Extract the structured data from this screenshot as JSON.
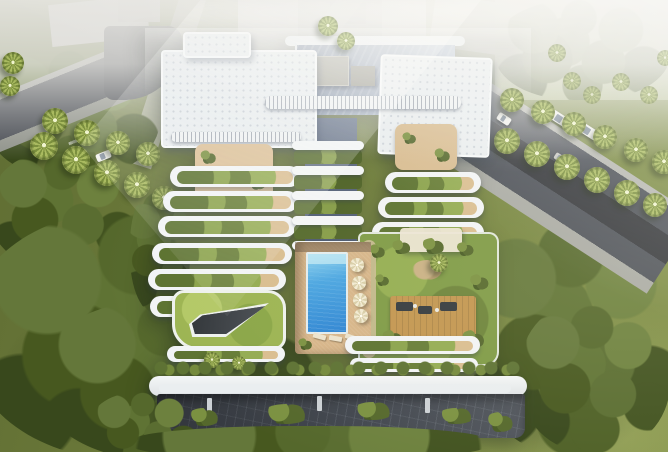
{
  "scene": {
    "type": "aerial-architectural-rendering",
    "description": "Aerial render of a luxury terraced residential building with cascading planted balconies, a rooftop courtyard with rectangular swimming pool and cream umbrellas, a lawn roof with an angular water feature, a garden lounge terrace with wooden deck, covered parking at grade, palm-lined streets with cars, dense surrounding trees and a hazy city background",
    "palette": {
      "haze_white": "#e8e7e3",
      "grass_green": "#6e7c3b",
      "tree_green": "#55682c",
      "asphalt_gray": "#42464e",
      "building_white": "#f2f4f6",
      "roof_deck_blue_gray": "#93a0b2",
      "pool_blue": "#2e86d4",
      "deck_beige": "#d6b488",
      "umbrella_cream": "#f1ead2",
      "roof_lawn_green": "#9cb452",
      "wood_deck_tan": "#c2954f",
      "water_feature_dark": "#3b3f43"
    },
    "counts": {
      "pool_umbrellas": 4,
      "cars": 5,
      "palm_trees": 34,
      "terrace_rows_left": 6,
      "terrace_rows_right": 5,
      "central_garden_bridges": 5
    }
  }
}
